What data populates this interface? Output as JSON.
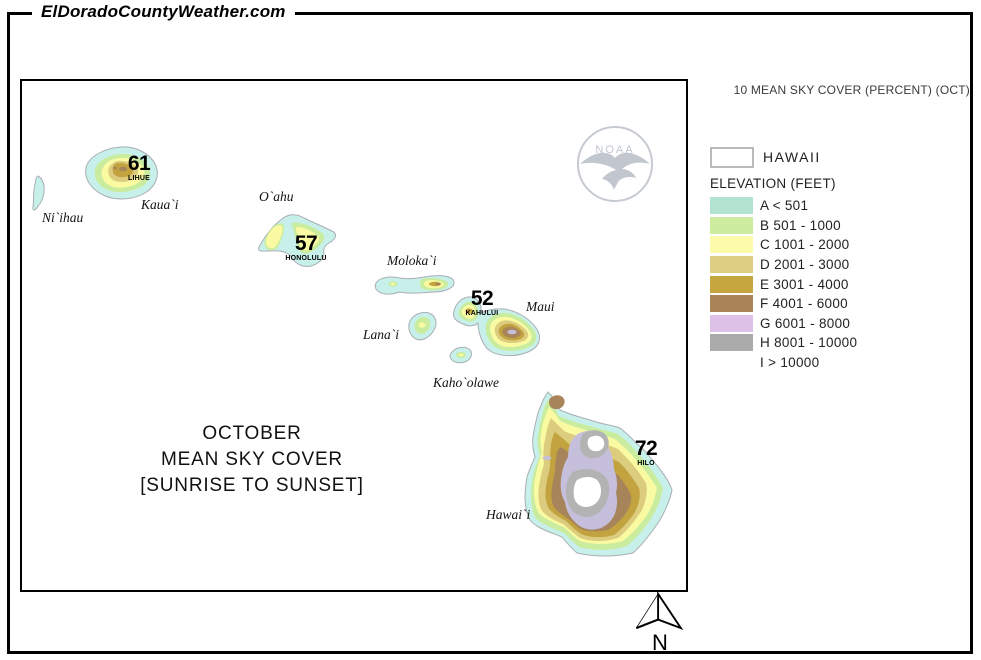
{
  "brand": "ElDoradoCountyWeather.com",
  "corner_label": "10 MEAN SKY COVER (PERCENT) (OCT)",
  "map": {
    "title_lines": [
      "OCTOBER",
      "MEAN SKY COVER",
      "[SUNRISE TO SUNSET]"
    ],
    "island_labels": [
      {
        "text": "Ni`ihau"
      },
      {
        "text": "Kaua`i"
      },
      {
        "text": "O`ahu"
      },
      {
        "text": "Moloka`i"
      },
      {
        "text": "Lana`i"
      },
      {
        "text": "Maui"
      },
      {
        "text": "Kaho`olawe"
      },
      {
        "text": "Hawai`i"
      }
    ],
    "stations": [
      {
        "value": "61",
        "name": "LIHUE"
      },
      {
        "value": "57",
        "name": "HONOLULU"
      },
      {
        "value": "52",
        "name": "KAHULUI"
      },
      {
        "value": "72",
        "name": "HILO"
      }
    ],
    "north_label": "N",
    "noaa_text": "NOAA",
    "palette": {
      "A": "#c8f0ea",
      "B": "#c9ec9e",
      "C": "#fafaa2",
      "D": "#dccc7e",
      "E": "#c2a33f",
      "F": "#a8845a",
      "G": "#c6bfdb",
      "H": "#b3b3b3",
      "I": "#ffffff",
      "coastline": "#a9aeb5"
    }
  },
  "legend": {
    "region_label": "HAWAII",
    "section_title": "ELEVATION (FEET)",
    "items": [
      {
        "code": "A",
        "label": "A < 501",
        "color": "#b2e2d0"
      },
      {
        "code": "B",
        "label": "B 501 - 1000",
        "color": "#cdec9f"
      },
      {
        "code": "C",
        "label": "C 1001 - 2000",
        "color": "#fbfba9"
      },
      {
        "code": "D",
        "label": "D 2001 - 3000",
        "color": "#ddce81"
      },
      {
        "code": "E",
        "label": "E 3001 - 4000",
        "color": "#c6a63f"
      },
      {
        "code": "F",
        "label": "F 4001 - 6000",
        "color": "#a98459"
      },
      {
        "code": "G",
        "label": "G 6001 - 8000",
        "color": "#ddc1e7"
      },
      {
        "code": "H",
        "label": "H 8001 - 10000",
        "color": "#ababab"
      },
      {
        "code": "I",
        "label": "I > 10000",
        "color": "#ffffff"
      }
    ]
  }
}
